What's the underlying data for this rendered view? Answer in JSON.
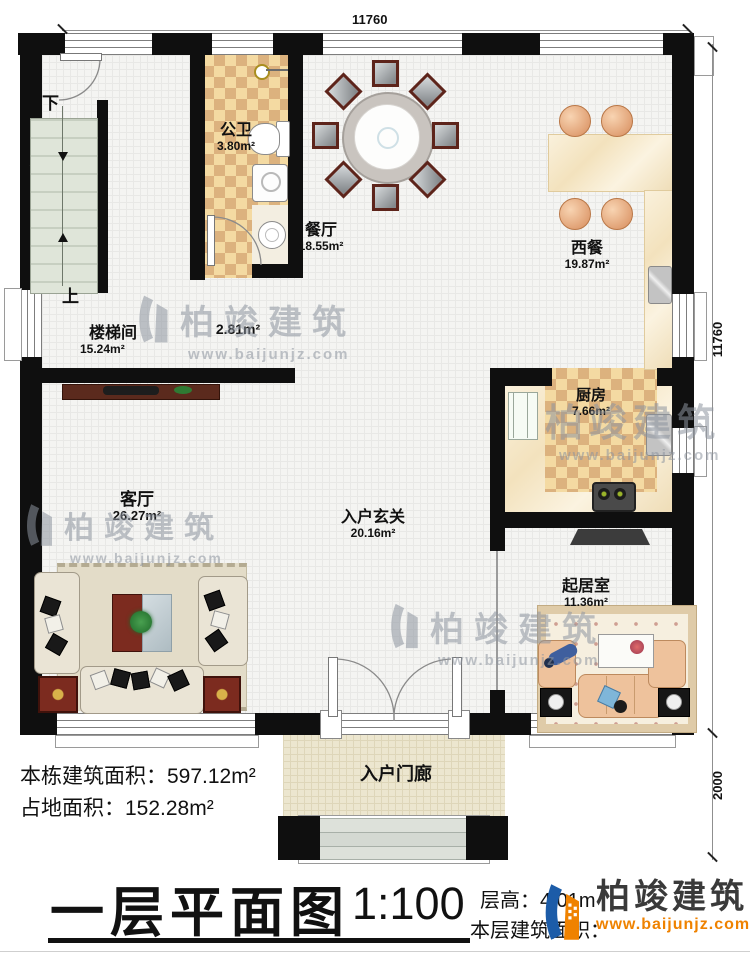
{
  "dimensions": {
    "top": "11760",
    "right_main": "11760",
    "right_porch": "2000"
  },
  "rooms": {
    "gongwei": {
      "name": "公卫",
      "area": "3.80m²"
    },
    "canting": {
      "name": "餐厅",
      "area": "18.55m²"
    },
    "xican": {
      "name": "西餐",
      "area": "19.87m²"
    },
    "loutijian": {
      "name": "楼梯间",
      "area": "15.24m²"
    },
    "corridor": {
      "area": "2.81m²"
    },
    "keting": {
      "name": "客厅",
      "area": "26.27m²"
    },
    "chufang": {
      "name": "厨房",
      "area": "7.66m²"
    },
    "xuanguan": {
      "name": "入户玄关",
      "area": "20.16m²"
    },
    "qijushi": {
      "name": "起居室",
      "area": "11.36m²"
    },
    "menlang": {
      "name": "入户门廊"
    }
  },
  "stairs": {
    "down": "下",
    "up": "上"
  },
  "summary": {
    "building_area": "本栋建筑面积：597.12m²",
    "footprint_area": "占地面积：152.28m²"
  },
  "titleblock": {
    "title": "一层平面图",
    "scale": "1:100",
    "floor_height": "层高：4.01m",
    "floor_area_label": "本层建筑面积："
  },
  "brand": {
    "name": "柏竣建筑",
    "url": "www.baijunjz.com"
  },
  "watermark": {
    "name": "柏竣建筑",
    "url": "www.baijunjz.com"
  },
  "colors": {
    "logo_blue": "#1c5ca8",
    "logo_orange": "#ef8200",
    "wall": "#0f0f0f"
  }
}
